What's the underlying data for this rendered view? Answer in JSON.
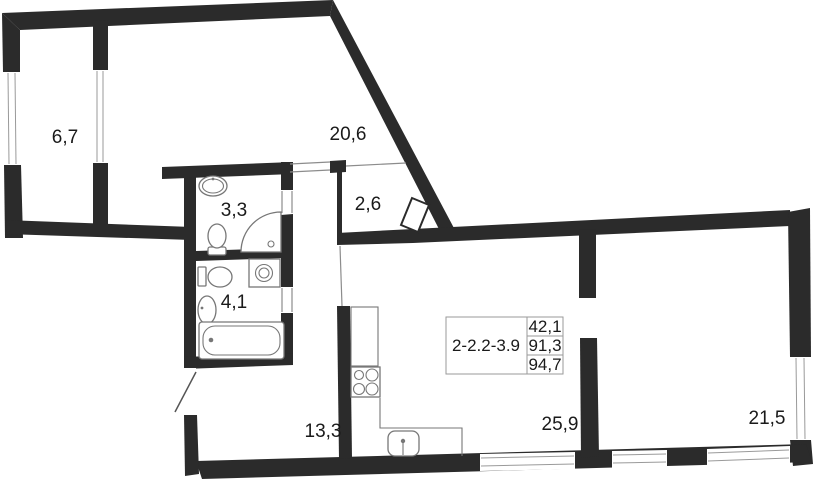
{
  "plan": {
    "unit_label": "2-2.2-3.9",
    "unit_area_values": [
      "42,1",
      "91,3",
      "94,7"
    ],
    "rooms": [
      {
        "id": "loggia",
        "area": "6,7"
      },
      {
        "id": "living-room",
        "area": "20,6"
      },
      {
        "id": "bathroom",
        "area": "3,3"
      },
      {
        "id": "wardrobe",
        "area": "2,6"
      },
      {
        "id": "bathroom-2",
        "area": "4,1"
      },
      {
        "id": "hallway",
        "area": "13,3"
      },
      {
        "id": "kitchen-living-room",
        "area": "25,9"
      },
      {
        "id": "bedroom",
        "area": "21,5"
      }
    ]
  },
  "colors": {
    "wall": "#2b2b2b",
    "fixture_line": "#777777",
    "glazing_line": "#9a9a9a",
    "text": "#1a1a1a",
    "background": "#ffffff"
  }
}
